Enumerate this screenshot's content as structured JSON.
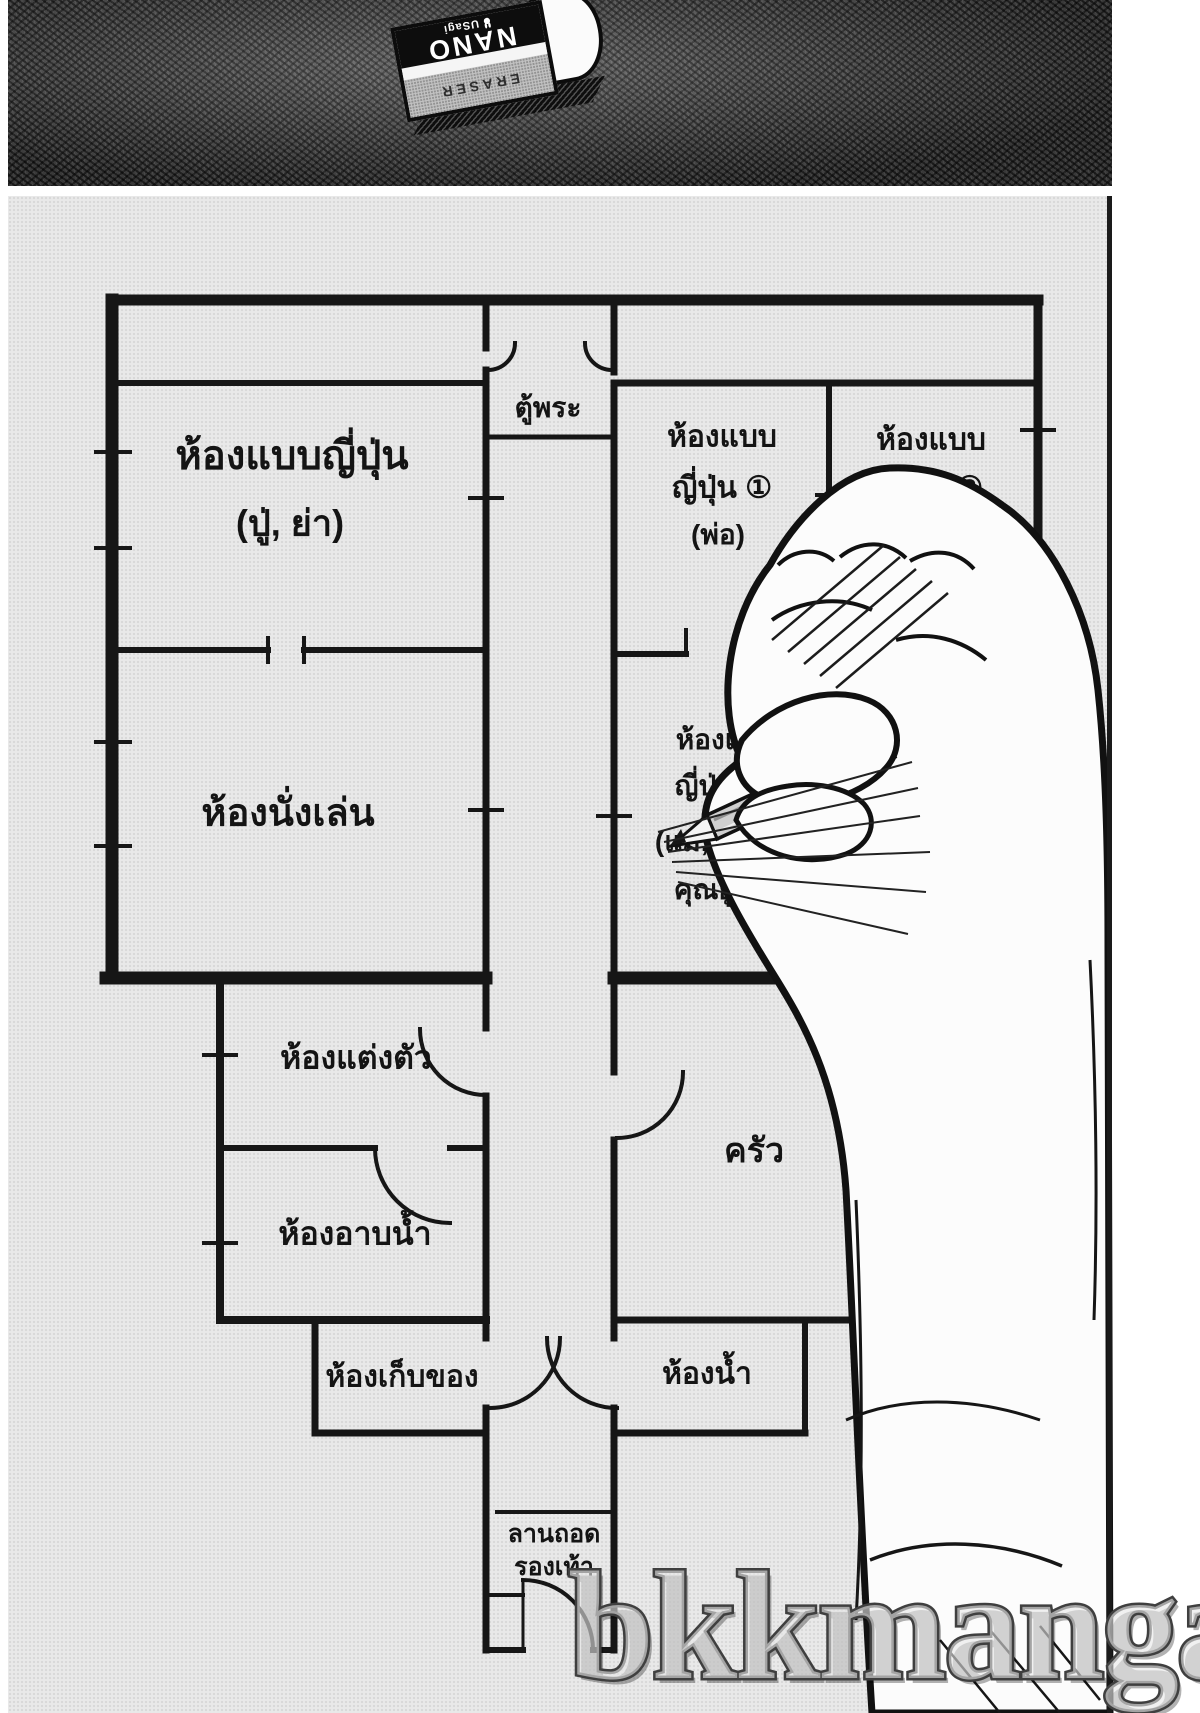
{
  "watermark": "bkkmanga",
  "eraser": {
    "brand": "NANO",
    "maker": "USagi",
    "product_type": "ERASER"
  },
  "floorplan": {
    "altar": "ตู้พระ",
    "room_grandparents": {
      "line1": "ห้องแบบญี่ปุ่น",
      "line2": "(ปู่, ย่า)"
    },
    "room_father": {
      "line1": "ห้องแบบ",
      "line2": "ญี่ปุ่น ①",
      "line3": "(พ่อ)"
    },
    "room_two": {
      "line1": "ห้องแบบ",
      "line2": "ญี่ปุ่น ②"
    },
    "living_room": "ห้องนั่งเล่น",
    "room_mother": {
      "line1": "ห้องแบบ",
      "line2": "ญี่ปุ่น",
      "line3": "(แม่, พลาว,",
      "line4": "คุณยูซุกิ)"
    },
    "dressing_room": "ห้องแต่งตัว",
    "kitchen": "ครัว",
    "bathroom": "ห้องอาบน้ำ",
    "storage_room": "ห้องเก็บของ",
    "toilet": "ห้องน้ำ",
    "genkan": {
      "line1": "ลานถอด",
      "line2": "รองเท้า"
    }
  },
  "colors": {
    "paper": "#e9e9e9",
    "ink": "#161616",
    "pencil_body": "#cfcfcf",
    "table": "#4f4f4f"
  }
}
